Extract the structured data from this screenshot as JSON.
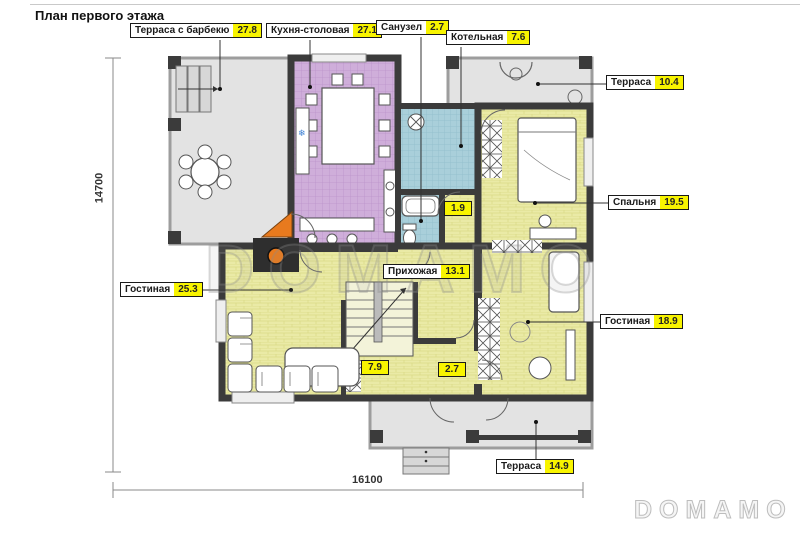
{
  "title": "План первого этажа",
  "watermarks": {
    "center": "DOMAMO",
    "corner": "DOMAMO"
  },
  "dimensions": {
    "vertical": "14700",
    "horizontal": "16100"
  },
  "callouts": [
    {
      "id": "terrace-bbq",
      "name": "Терраса с барбекю",
      "area": "27.8"
    },
    {
      "id": "kitchen-dining",
      "name": "Кухня-столовая",
      "area": "27.1"
    },
    {
      "id": "bathroom",
      "name": "Санузел",
      "area": "2.7"
    },
    {
      "id": "boiler",
      "name": "Котельная",
      "area": "7.6"
    },
    {
      "id": "terrace-top",
      "name": "Терраса",
      "area": "10.4"
    },
    {
      "id": "bedroom",
      "name": "Спальня",
      "area": "19.5"
    },
    {
      "id": "living-right",
      "name": "Гостиная",
      "area": "18.9"
    },
    {
      "id": "living-left",
      "name": "Гостиная",
      "area": "25.3"
    },
    {
      "id": "hallway",
      "name": "Прихожая",
      "area": "13.1"
    },
    {
      "id": "terrace-bottom",
      "name": "Терраса",
      "area": "14.9"
    }
  ],
  "area_tags": [
    {
      "id": "wc-small",
      "value": "1.9"
    },
    {
      "id": "stair-hall",
      "value": "7.9"
    },
    {
      "id": "corridor",
      "value": "2.7"
    }
  ],
  "colors": {
    "wall": "#3b3b3b",
    "floor_yellow": "#eaeaa6",
    "floor_purple": "#cfaeda",
    "floor_teal": "#a9cfda",
    "floor_gray": "#e3e3e3",
    "label_highlight": "#f8f400",
    "fireplace_orange": "#e87a1e"
  }
}
